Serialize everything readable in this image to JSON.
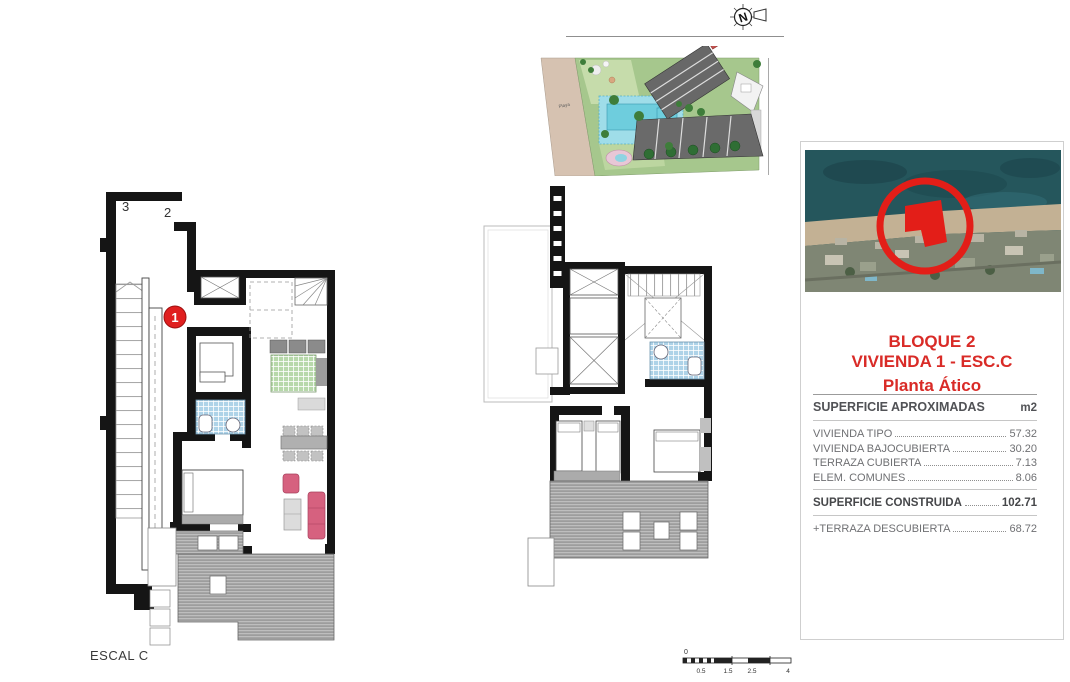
{
  "document": {
    "escal_label": "ESCAL C"
  },
  "north_arrow": {
    "letter": "N"
  },
  "site_plan": {
    "beach_label": "Playa"
  },
  "left_plan": {
    "stair_label_top": "3",
    "stair_label_right": "2",
    "unit_number": "1"
  },
  "location_panel": {
    "title_line1": "BLOQUE 2",
    "title_line2": "VIVIENDA 1 - ESC.C",
    "title_line3": "Planta Ático",
    "surface_table": {
      "header": "SUPERFICIE APROXIMADAS",
      "unit": "m2",
      "rows": [
        {
          "label": "VIVIENDA TIPO",
          "value": "57.32"
        },
        {
          "label": "VIVIENDA BAJOCUBIERTA",
          "value": "30.20"
        },
        {
          "label": "TERRAZA CUBIERTA",
          "value": "7.13"
        },
        {
          "label": "ELEM. COMUNES",
          "value": "8.06"
        }
      ],
      "total_label": "SUPERFICIE CONSTRUIDA",
      "total_value": "102.71",
      "extra_label": "+TERRAZA DESCUBIERTA",
      "extra_value": "68.72"
    }
  },
  "scale_bar": {
    "origin": "0",
    "labels": [
      "0.5",
      "1.5",
      "2.5",
      "4"
    ]
  },
  "colors": {
    "accent_red": "#d92b27",
    "marker_red": "#e31e18",
    "wall_black": "#151515",
    "deck_gray": "#9d9d9d",
    "tile_blue": "#aed3e8",
    "grid_green": "#b7d8aa",
    "sofa_pink": "#d6617f",
    "beach_tan": "#d6c2b1",
    "lawn_green": "#a6c78d",
    "pool_cyan": "#6ecddd",
    "sea_teal": "#25565c"
  }
}
